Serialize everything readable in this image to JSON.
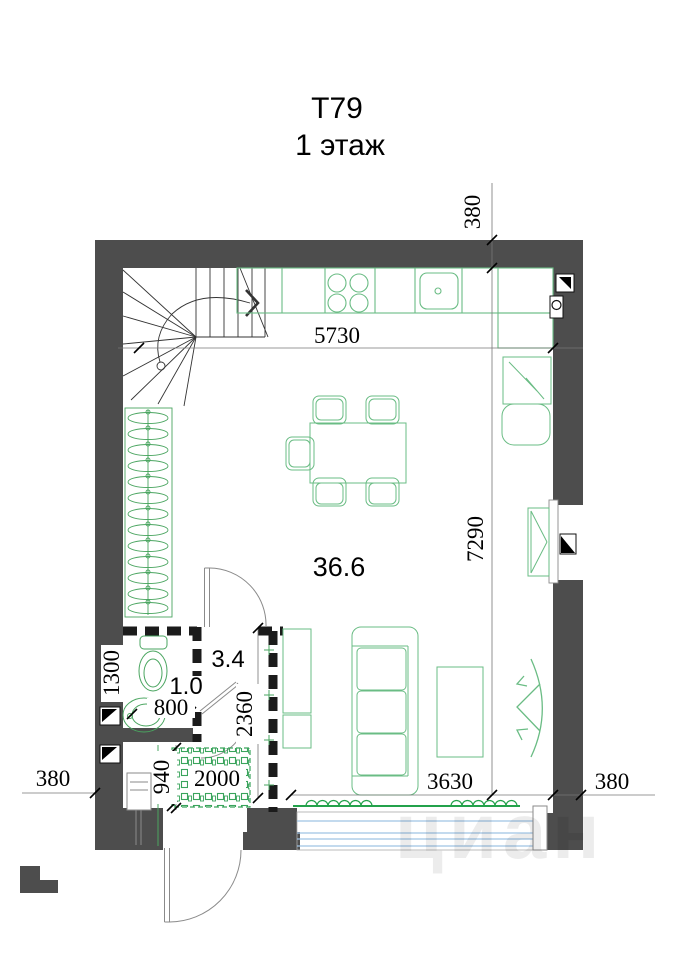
{
  "title": {
    "line1": "Т79",
    "line2": "1 этаж"
  },
  "rooms": {
    "living": {
      "area": "36.6"
    },
    "hall": {
      "area": "3.4"
    },
    "wc": {
      "area": "1.0"
    }
  },
  "dimensions": {
    "wall_top": "380",
    "width_top": "5730",
    "height_right": "7290",
    "wc_depth": "1300",
    "wc_width": "800",
    "hall_depth": "2360",
    "entry_depth": "940",
    "entry_width": "2000",
    "window_width": "3630",
    "wall_left": "380",
    "wall_right": "380"
  },
  "watermark": "циан",
  "colors": {
    "wall": "#4d4d4d",
    "furniture_green": "#5eb87e",
    "convector_green": "#23a24b",
    "glazing_blue": "#9fc3e4",
    "stair_line": "#333333"
  }
}
